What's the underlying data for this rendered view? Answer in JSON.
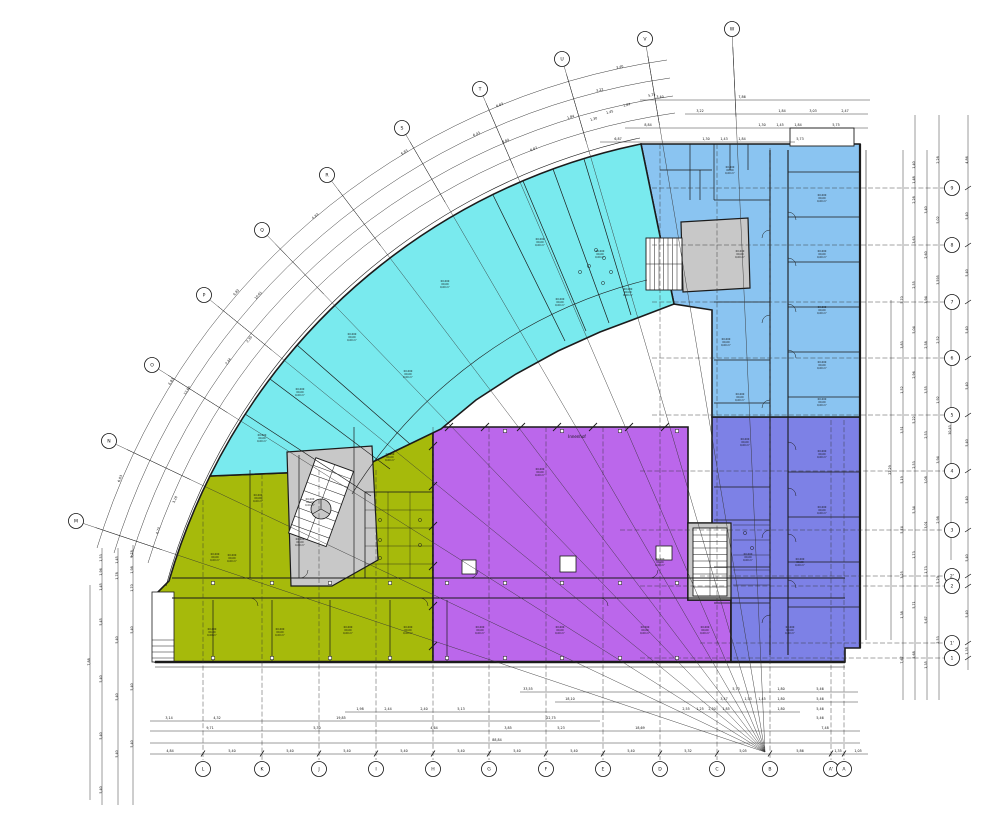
{
  "meta": {
    "drawing_type": "architectural floor plan",
    "shape": "quarter-arc building with three straight wings"
  },
  "colors": {
    "cyan_wing": "#79EAEE",
    "lightblue_wing": "#8AC4F1",
    "periwinkle_wing": "#7D81E6",
    "purple_wing": "#BB67EB",
    "olive_wing": "#A6BA0B",
    "core_gray": "#C8C8C8",
    "wall": "#1b1b1b",
    "line": "#222222"
  },
  "geometry": {
    "fx": 765,
    "fy": 752
  },
  "labels": {
    "courtyard": "Innenhof"
  },
  "grid": {
    "arc_bubbles": [
      {
        "label": "M",
        "x": 76,
        "y": 521
      },
      {
        "label": "N",
        "x": 109,
        "y": 441
      },
      {
        "label": "O",
        "x": 152,
        "y": 365
      },
      {
        "label": "P",
        "x": 204,
        "y": 295
      },
      {
        "label": "Q",
        "x": 262,
        "y": 230
      },
      {
        "label": "R",
        "x": 327,
        "y": 175
      },
      {
        "label": "S",
        "x": 402,
        "y": 128
      },
      {
        "label": "T",
        "x": 480,
        "y": 89
      },
      {
        "label": "U",
        "x": 562,
        "y": 59
      },
      {
        "label": "V",
        "x": 645,
        "y": 39
      },
      {
        "label": "W",
        "x": 732,
        "y": 29
      }
    ],
    "bottom_bubbles": [
      {
        "label": "L",
        "x": 203,
        "top": 500
      },
      {
        "label": "K",
        "x": 262,
        "top": 474
      },
      {
        "label": "J",
        "x": 319,
        "top": 470
      },
      {
        "label": "I",
        "x": 376,
        "top": 470
      },
      {
        "label": "H",
        "x": 433,
        "top": 427
      },
      {
        "label": "G",
        "x": 489,
        "top": 427
      },
      {
        "label": "F",
        "x": 546,
        "top": 427
      },
      {
        "label": "E",
        "x": 603,
        "top": 427
      },
      {
        "label": "D",
        "x": 660,
        "top": 144
      },
      {
        "label": "C",
        "x": 717,
        "top": 144
      },
      {
        "label": "B",
        "x": 770,
        "top": 148
      },
      {
        "label": "A'",
        "x": 831,
        "top": 420
      },
      {
        "label": "A",
        "x": 844,
        "top": 420
      }
    ],
    "right_bubbles": [
      {
        "label": "9",
        "y": 188,
        "left": 652
      },
      {
        "label": "8",
        "y": 245,
        "left": 652
      },
      {
        "label": "7",
        "y": 302,
        "left": 652
      },
      {
        "label": "6",
        "y": 358,
        "left": 652
      },
      {
        "label": "5",
        "y": 415,
        "left": 652
      },
      {
        "label": "4",
        "y": 471,
        "left": 640
      },
      {
        "label": "3",
        "y": 530,
        "left": 620
      },
      {
        "label": "2'",
        "y": 576,
        "left": 700
      },
      {
        "label": "2",
        "y": 586,
        "left": 640
      },
      {
        "label": "1'",
        "y": 643,
        "left": 700
      },
      {
        "label": "1",
        "y": 658,
        "left": 640
      }
    ]
  },
  "dims": {
    "horizontal": [
      {
        "y": 690,
        "entries": [
          {
            "x": 528,
            "v": "33,55"
          },
          {
            "x": 736,
            "v": "5,73"
          },
          {
            "x": 781,
            "v": "1,80"
          },
          {
            "x": 820,
            "v": "5,46"
          }
        ]
      },
      {
        "y": 700,
        "entries": [
          {
            "x": 570,
            "v": "18,10"
          },
          {
            "x": 724,
            "v": "3,47"
          },
          {
            "x": 748,
            "v": "1,53"
          },
          {
            "x": 762,
            "v": "1,45"
          },
          {
            "x": 781,
            "v": "1,80"
          },
          {
            "x": 820,
            "v": "5,46"
          }
        ]
      },
      {
        "y": 710,
        "entries": [
          {
            "x": 360,
            "v": "1,98"
          },
          {
            "x": 388,
            "v": "2,44"
          },
          {
            "x": 424,
            "v": "2,40"
          },
          {
            "x": 461,
            "v": "5,13"
          },
          {
            "x": 686,
            "v": "2,55"
          },
          {
            "x": 700,
            "v": "1,25"
          },
          {
            "x": 712,
            "v": "2,30"
          },
          {
            "x": 726,
            "v": "1,85"
          },
          {
            "x": 781,
            "v": "1,80"
          },
          {
            "x": 820,
            "v": "5,46"
          }
        ]
      },
      {
        "y": 719,
        "entries": [
          {
            "x": 169,
            "v": "3,14"
          },
          {
            "x": 217,
            "v": "4,32"
          },
          {
            "x": 341,
            "v": "19,85"
          },
          {
            "x": 551,
            "v": "22,75"
          },
          {
            "x": 820,
            "v": "5,46"
          }
        ]
      },
      {
        "y": 729,
        "entries": [
          {
            "x": 210,
            "v": "9,71"
          },
          {
            "x": 317,
            "v": "5,30"
          },
          {
            "x": 434,
            "v": "4,64"
          },
          {
            "x": 508,
            "v": "3,85"
          },
          {
            "x": 561,
            "v": "5,23"
          },
          {
            "x": 640,
            "v": "18,69"
          },
          {
            "x": 825,
            "v": "7,48"
          }
        ]
      },
      {
        "y": 741,
        "entries": [
          {
            "x": 497,
            "v": "88,84"
          }
        ]
      },
      {
        "y": 752,
        "entries": [
          {
            "x": 170,
            "v": "4,84"
          },
          {
            "x": 232,
            "v": "5,40"
          },
          {
            "x": 290,
            "v": "5,40"
          },
          {
            "x": 347,
            "v": "5,40"
          },
          {
            "x": 404,
            "v": "5,40"
          },
          {
            "x": 461,
            "v": "5,40"
          },
          {
            "x": 517,
            "v": "5,40"
          },
          {
            "x": 574,
            "v": "5,40"
          },
          {
            "x": 631,
            "v": "5,40"
          },
          {
            "x": 688,
            "v": "5,32"
          },
          {
            "x": 743,
            "v": "5,05"
          },
          {
            "x": 800,
            "v": "5,86"
          },
          {
            "x": 838,
            "v": "1,35"
          },
          {
            "x": 858,
            "v": "1,05"
          }
        ]
      },
      {
        "y": 98,
        "entries": [
          {
            "x": 660,
            "v": "3,40"
          },
          {
            "x": 742,
            "v": "7,86"
          }
        ]
      },
      {
        "y": 112,
        "entries": [
          {
            "x": 700,
            "v": "3,22"
          },
          {
            "x": 782,
            "v": "1,84"
          },
          {
            "x": 813,
            "v": "3,03"
          },
          {
            "x": 845,
            "v": "2,47"
          }
        ]
      },
      {
        "y": 126,
        "entries": [
          {
            "x": 648,
            "v": "8,84"
          },
          {
            "x": 762,
            "v": "1,30"
          },
          {
            "x": 780,
            "v": "1,45"
          },
          {
            "x": 798,
            "v": "1,84"
          },
          {
            "x": 836,
            "v": "5,75"
          }
        ]
      },
      {
        "y": 140,
        "entries": [
          {
            "x": 618,
            "v": "6,87"
          },
          {
            "x": 706,
            "v": "1,30"
          },
          {
            "x": 724,
            "v": "1,43"
          },
          {
            "x": 742,
            "v": "1,84"
          },
          {
            "x": 800,
            "v": "5,73"
          }
        ]
      }
    ],
    "vertical": [
      {
        "x": 90,
        "entries": [
          {
            "y": 662,
            "v": "7,88"
          }
        ]
      },
      {
        "x": 102,
        "entries": [
          {
            "y": 558,
            "v": "1,53"
          },
          {
            "y": 572,
            "v": "1,96"
          },
          {
            "y": 587,
            "v": "1,45"
          },
          {
            "y": 622,
            "v": "5,45"
          },
          {
            "y": 679,
            "v": "5,40"
          },
          {
            "y": 736,
            "v": "5,40"
          },
          {
            "y": 790,
            "v": "5,40"
          }
        ]
      },
      {
        "x": 118,
        "entries": [
          {
            "y": 560,
            "v": "1,45"
          },
          {
            "y": 576,
            "v": "1,78"
          },
          {
            "y": 640,
            "v": "5,40"
          },
          {
            "y": 697,
            "v": "5,40"
          },
          {
            "y": 754,
            "v": "5,40"
          }
        ]
      },
      {
        "x": 133,
        "entries": [
          {
            "y": 554,
            "v": "2,78"
          },
          {
            "y": 570,
            "v": "1,98"
          },
          {
            "y": 588,
            "v": "1,70"
          },
          {
            "y": 630,
            "v": "5,40"
          },
          {
            "y": 687,
            "v": "5,40"
          },
          {
            "y": 744,
            "v": "5,40"
          }
        ]
      },
      {
        "x": 891,
        "entries": [
          {
            "y": 470,
            "v": "22,29"
          }
        ]
      },
      {
        "x": 903,
        "entries": [
          {
            "y": 300,
            "v": "5,70"
          },
          {
            "y": 345,
            "v": "3,83"
          },
          {
            "y": 390,
            "v": "1,52"
          },
          {
            "y": 430,
            "v": "3,51"
          },
          {
            "y": 480,
            "v": "5,19"
          },
          {
            "y": 530,
            "v": "5,74"
          },
          {
            "y": 575,
            "v": "3,25"
          },
          {
            "y": 615,
            "v": "1,38"
          },
          {
            "y": 660,
            "v": "7,67"
          }
        ]
      },
      {
        "x": 915,
        "entries": [
          {
            "y": 165,
            "v": "1,40"
          },
          {
            "y": 180,
            "v": "1,48"
          },
          {
            "y": 200,
            "v": "2,28"
          },
          {
            "y": 240,
            "v": "3,63"
          },
          {
            "y": 285,
            "v": "2,55"
          },
          {
            "y": 330,
            "v": "5,04"
          },
          {
            "y": 375,
            "v": "2,96"
          },
          {
            "y": 420,
            "v": "5,22"
          },
          {
            "y": 465,
            "v": "2,53"
          },
          {
            "y": 510,
            "v": "5,34"
          },
          {
            "y": 555,
            "v": "1,73"
          },
          {
            "y": 605,
            "v": "5,71"
          },
          {
            "y": 655,
            "v": "5,68"
          }
        ]
      },
      {
        "x": 927,
        "entries": [
          {
            "y": 210,
            "v": "3,40"
          },
          {
            "y": 255,
            "v": "2,60"
          },
          {
            "y": 300,
            "v": "3,94"
          },
          {
            "y": 345,
            "v": "2,58"
          },
          {
            "y": 390,
            "v": "3,55"
          },
          {
            "y": 435,
            "v": "2,53"
          },
          {
            "y": 480,
            "v": "3,08"
          },
          {
            "y": 525,
            "v": "3,01"
          },
          {
            "y": 570,
            "v": "1,73"
          },
          {
            "y": 620,
            "v": "5,67"
          },
          {
            "y": 665,
            "v": "1,35"
          }
        ]
      },
      {
        "x": 939,
        "entries": [
          {
            "y": 160,
            "v": "2,28"
          },
          {
            "y": 220,
            "v": "5,02"
          },
          {
            "y": 280,
            "v": "3,595"
          },
          {
            "y": 340,
            "v": "2,52"
          },
          {
            "y": 400,
            "v": "1,92"
          },
          {
            "y": 460,
            "v": "3,94"
          },
          {
            "y": 520,
            "v": "2,98"
          },
          {
            "y": 580,
            "v": "5,29"
          },
          {
            "y": 640,
            "v": "2,53"
          }
        ]
      },
      {
        "x": 951,
        "entries": [
          {
            "y": 430,
            "v": "30,43"
          }
        ]
      },
      {
        "x": 968,
        "entries": [
          {
            "y": 160,
            "v": "4,86"
          },
          {
            "y": 216,
            "v": "5,40"
          },
          {
            "y": 273,
            "v": "5,40"
          },
          {
            "y": 330,
            "v": "5,40"
          },
          {
            "y": 386,
            "v": "5,40"
          },
          {
            "y": 443,
            "v": "5,40"
          },
          {
            "y": 500,
            "v": "5,40"
          },
          {
            "y": 558,
            "v": "5,40"
          },
          {
            "y": 614,
            "v": "5,40"
          },
          {
            "y": 651,
            "v": "1,35"
          }
        ]
      }
    ],
    "arc": [
      {
        "x": 121,
        "y": 479,
        "r": -67,
        "v": "6,83"
      },
      {
        "x": 172,
        "y": 382,
        "r": -58,
        "v": "6,83"
      },
      {
        "x": 237,
        "y": 293,
        "r": -49,
        "v": "6,83"
      },
      {
        "x": 316,
        "y": 217,
        "r": -40,
        "v": "6,83"
      },
      {
        "x": 405,
        "y": 153,
        "r": -31,
        "v": "6,83"
      },
      {
        "x": 500,
        "y": 106,
        "r": -22,
        "v": "6,83"
      },
      {
        "x": 620,
        "y": 68,
        "r": -12,
        "v": "3,40"
      },
      {
        "x": 188,
        "y": 391,
        "r": -58,
        "v": "12,60"
      },
      {
        "x": 259,
        "y": 296,
        "r": -48,
        "v": "10,61"
      },
      {
        "x": 477,
        "y": 135,
        "r": -25,
        "v": "6,43"
      },
      {
        "x": 600,
        "y": 91,
        "r": -14,
        "v": "3,22"
      },
      {
        "x": 229,
        "y": 362,
        "r": -54,
        "v": "2,44"
      },
      {
        "x": 250,
        "y": 340,
        "r": -52,
        "v": "2,30"
      },
      {
        "x": 506,
        "y": 142,
        "r": -23,
        "v": "8,84"
      },
      {
        "x": 571,
        "y": 118,
        "r": -17,
        "v": "1,84"
      },
      {
        "x": 159,
        "y": 531,
        "r": -70,
        "v": "4,70"
      },
      {
        "x": 176,
        "y": 500,
        "r": -66,
        "v": "3,18"
      },
      {
        "x": 534,
        "y": 150,
        "r": -21,
        "v": "6,87"
      },
      {
        "x": 594,
        "y": 120,
        "r": -16,
        "v": "1,30"
      },
      {
        "x": 610,
        "y": 113,
        "r": -14,
        "v": "1,45"
      },
      {
        "x": 627,
        "y": 106,
        "r": -13,
        "v": "1,84"
      },
      {
        "x": 652,
        "y": 96,
        "r": -11,
        "v": "5,75"
      }
    ]
  },
  "rooms": {
    "placeholder": [
      "00.000",
      "00,00",
      "0,00 m²"
    ],
    "labels": [
      {
        "x": 445,
        "y": 282
      },
      {
        "x": 352,
        "y": 335
      },
      {
        "x": 300,
        "y": 390
      },
      {
        "x": 262,
        "y": 436
      },
      {
        "x": 408,
        "y": 372
      },
      {
        "x": 540,
        "y": 240
      },
      {
        "x": 600,
        "y": 252
      },
      {
        "x": 628,
        "y": 290
      },
      {
        "x": 560,
        "y": 300
      },
      {
        "x": 730,
        "y": 168
      },
      {
        "x": 822,
        "y": 196
      },
      {
        "x": 822,
        "y": 252
      },
      {
        "x": 822,
        "y": 308
      },
      {
        "x": 822,
        "y": 363
      },
      {
        "x": 740,
        "y": 252
      },
      {
        "x": 726,
        "y": 340
      },
      {
        "x": 740,
        "y": 395
      },
      {
        "x": 822,
        "y": 400
      },
      {
        "x": 822,
        "y": 452
      },
      {
        "x": 822,
        "y": 508
      },
      {
        "x": 800,
        "y": 560
      },
      {
        "x": 790,
        "y": 628
      },
      {
        "x": 745,
        "y": 440
      },
      {
        "x": 748,
        "y": 555
      },
      {
        "x": 540,
        "y": 470
      },
      {
        "x": 480,
        "y": 628
      },
      {
        "x": 560,
        "y": 628
      },
      {
        "x": 645,
        "y": 628
      },
      {
        "x": 705,
        "y": 628
      },
      {
        "x": 660,
        "y": 560
      },
      {
        "x": 212,
        "y": 630
      },
      {
        "x": 280,
        "y": 630
      },
      {
        "x": 348,
        "y": 628
      },
      {
        "x": 408,
        "y": 628
      },
      {
        "x": 232,
        "y": 556
      },
      {
        "x": 300,
        "y": 540
      },
      {
        "x": 258,
        "y": 496
      },
      {
        "x": 390,
        "y": 455
      },
      {
        "x": 310,
        "y": 500
      },
      {
        "x": 215,
        "y": 555
      }
    ]
  },
  "nodes": {
    "bottom_xs": [
      213,
      272,
      330,
      390,
      447,
      505,
      562,
      620,
      677
    ],
    "bottom_ys": [
      583,
      658
    ],
    "purple_top_xs": [
      505,
      562,
      620,
      677
    ],
    "purple_top_y": 431
  }
}
